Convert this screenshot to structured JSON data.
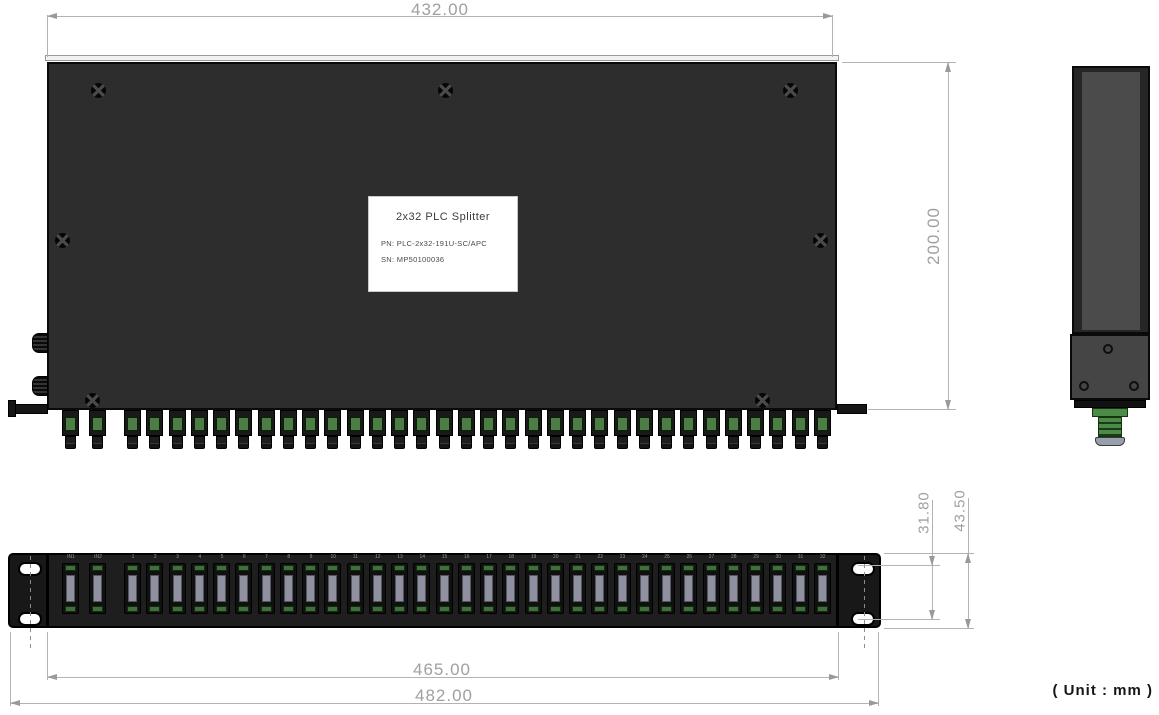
{
  "device_label": {
    "title": "2x32 PLC Splitter",
    "part_number": "PN:  PLC-2x32-191U-SC/APC",
    "serial_number": "SN:  MP50100036"
  },
  "dimensions": {
    "top_width": "432.00",
    "depth": "200.00",
    "front_body_width": "465.00",
    "front_overall_width": "482.00",
    "ear_slot_spacing": "31.80",
    "panel_height": "43.50"
  },
  "unit_note": "( Unit :  mm )",
  "ports": {
    "input_count": 2,
    "output_count": 32,
    "input_labels": [
      "IN1",
      "IN2"
    ],
    "output_numbering_start": 1
  },
  "colors": {
    "chassis": "#2d2d2d",
    "connector_green": "#4c7d45",
    "adapter_plug": "#8f90a0",
    "dimension_gray": "#9b9b9b",
    "label_background": "#ffffff"
  }
}
